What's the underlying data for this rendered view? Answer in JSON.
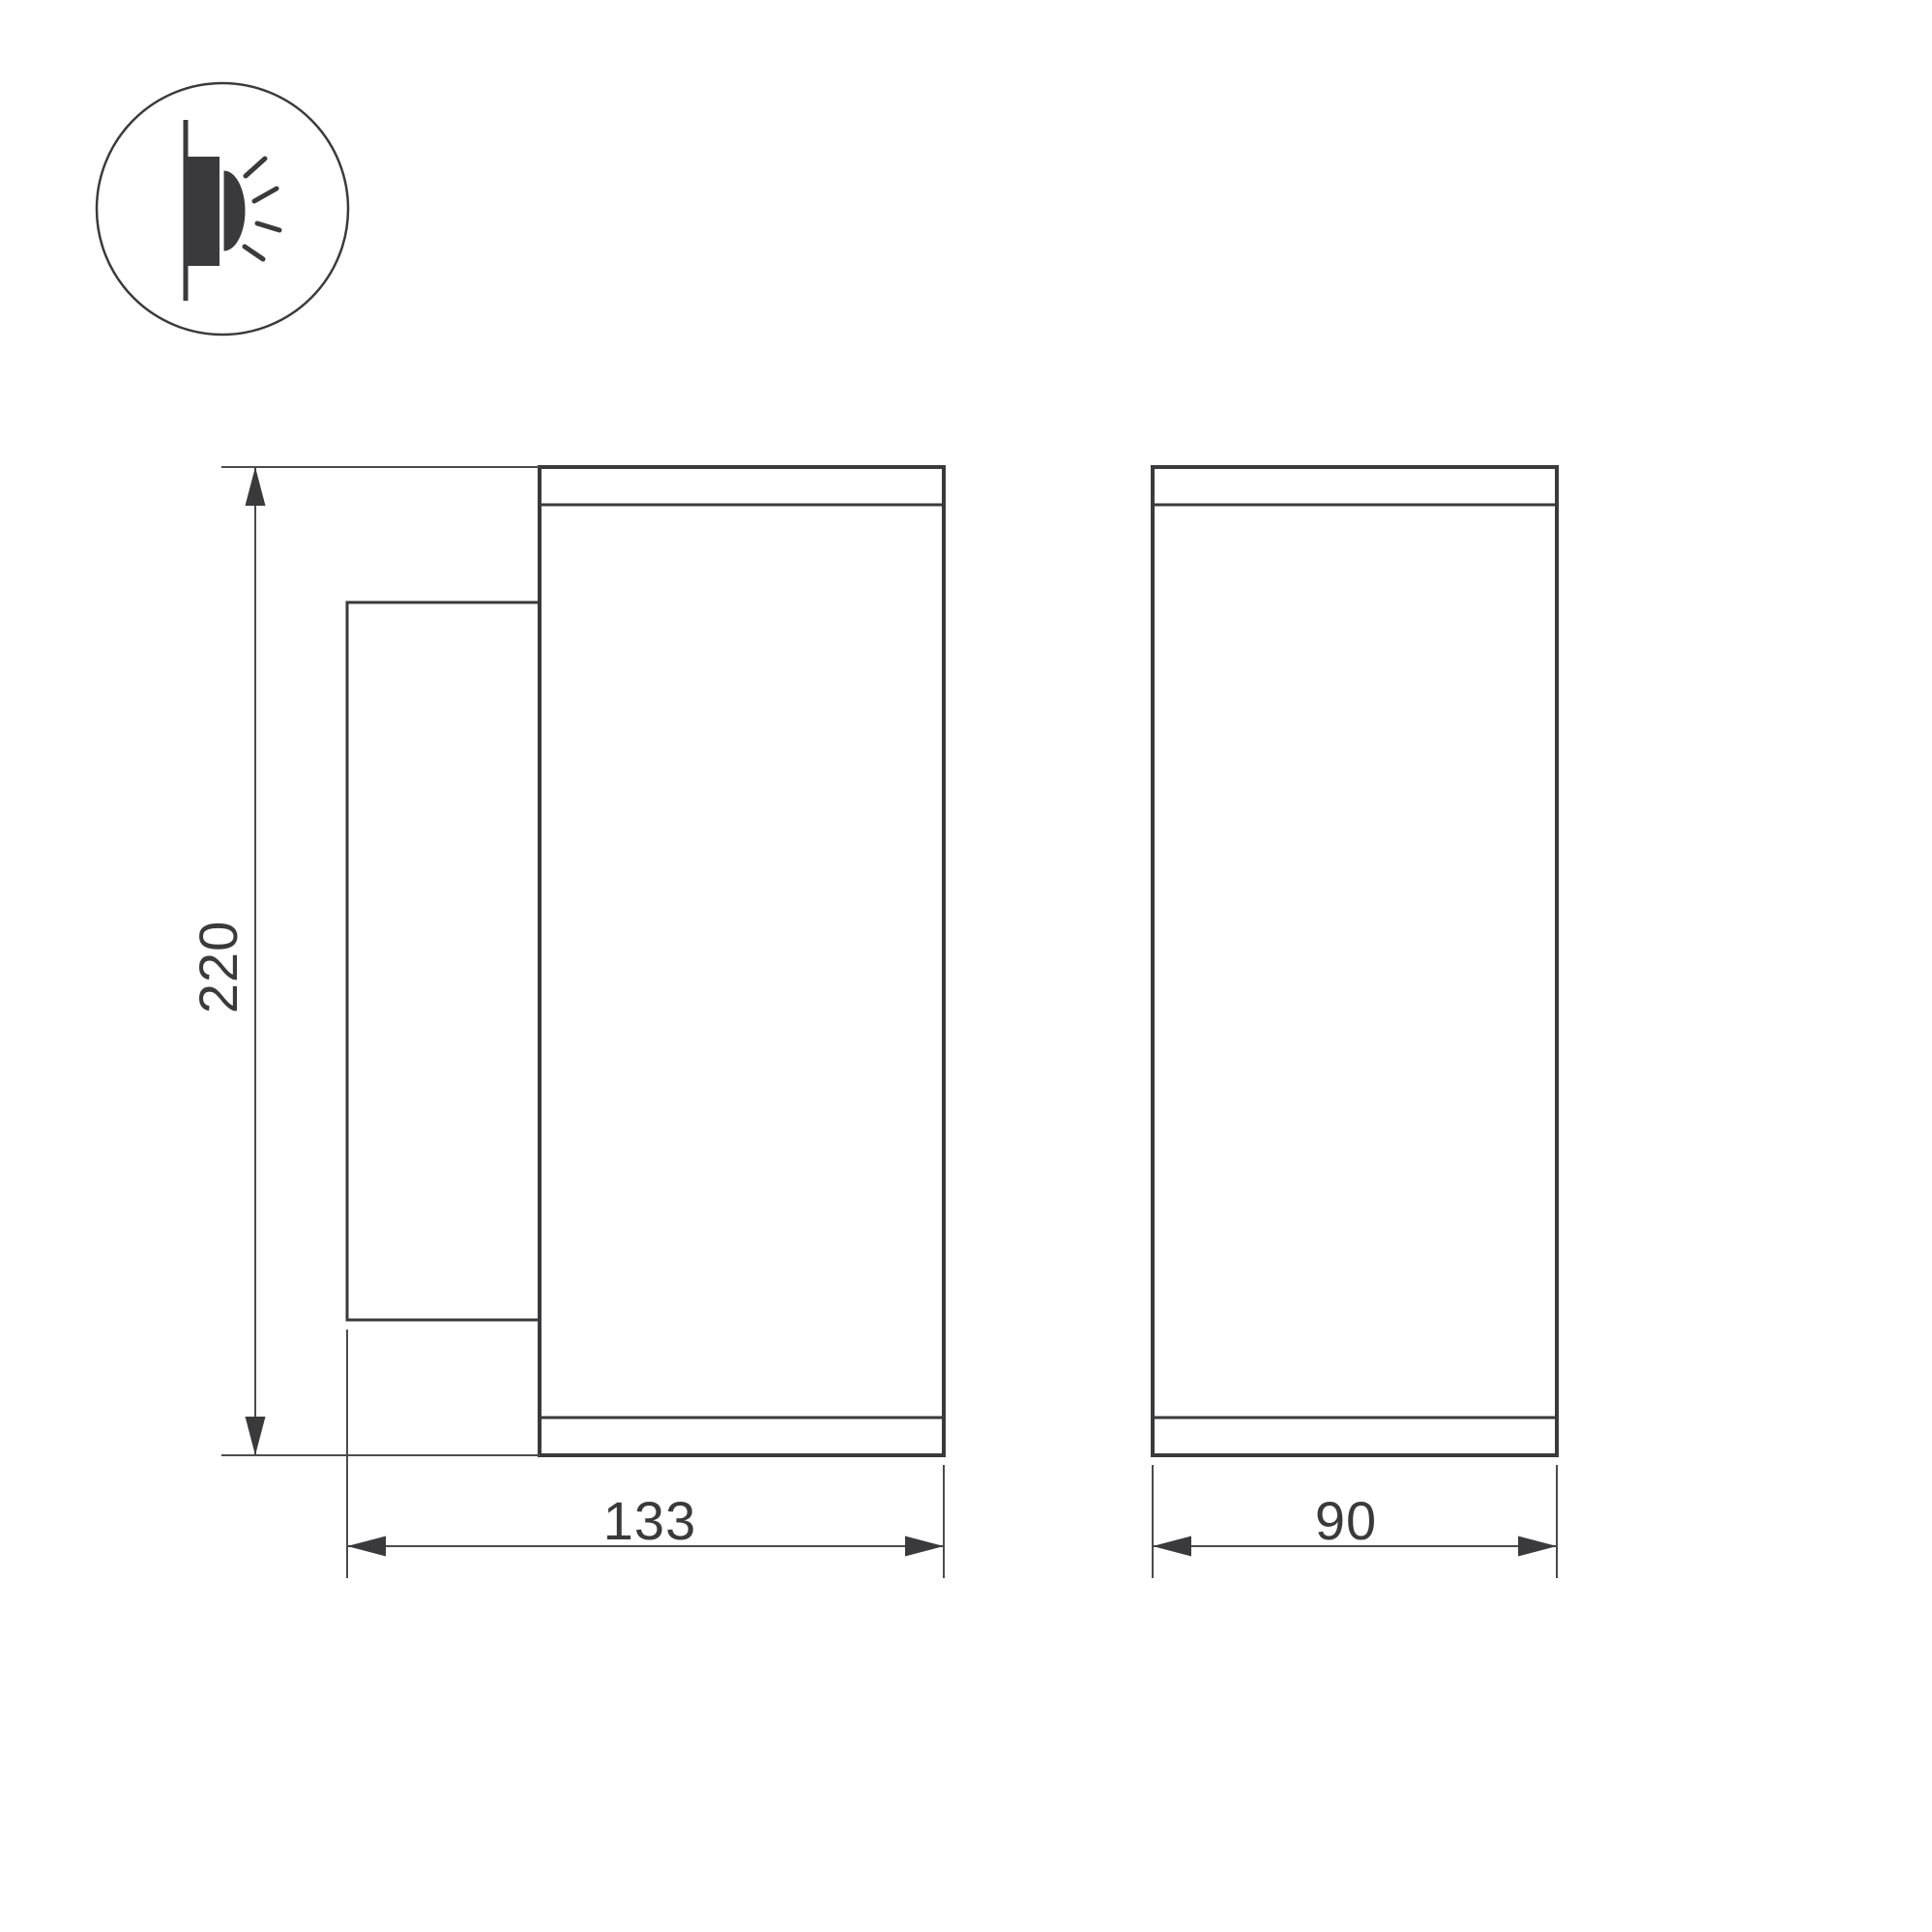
{
  "drawing": {
    "type": "technical-dimension-drawing",
    "background": "#ffffff",
    "colors": {
      "outline": "#3a3a3c",
      "thin_line": "#4b4b4e",
      "text": "#3a3a3c"
    },
    "icon": {
      "name": "wall-mount-light-emission-icon",
      "description": "circle containing a wall line, mounted fixture block and half-dome emitting four light rays"
    },
    "dimensions": {
      "height": "220",
      "depth": "133",
      "width": "90"
    }
  }
}
